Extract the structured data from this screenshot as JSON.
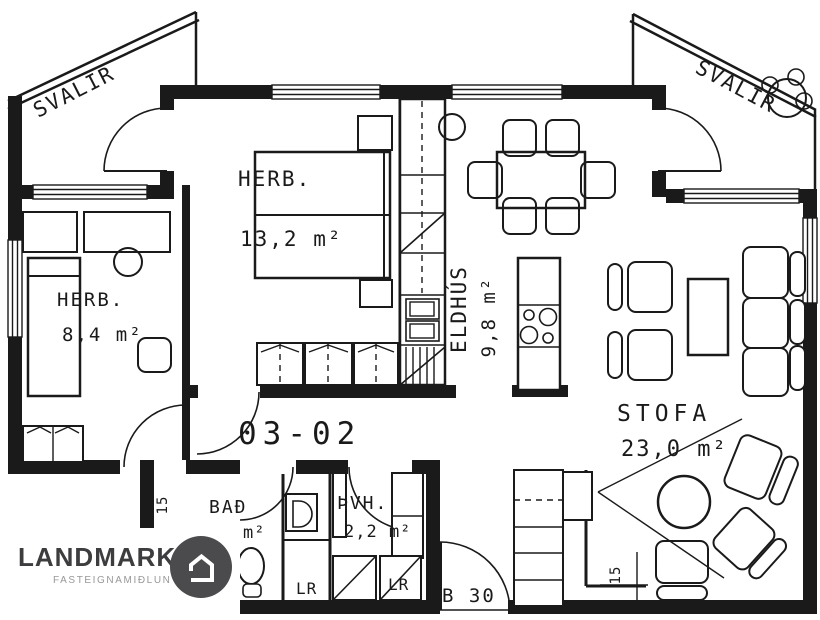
{
  "plan": {
    "unit_number": "03-02",
    "balconies": {
      "left": "SVALIR",
      "right": "SVALIR"
    },
    "rooms": {
      "bedroom_large": {
        "label": "HERB.",
        "area": "13,2 m²"
      },
      "bedroom_small": {
        "label": "HERB.",
        "area": "8,4 m²"
      },
      "kitchen": {
        "label": "ELDHÚS",
        "area": "9,8 m²"
      },
      "living_room": {
        "label": "STOFA",
        "area": "23,0 m²"
      },
      "bathroom": {
        "label": "BAÐ",
        "area_partial": "m²"
      },
      "laundry": {
        "label": "ÞVH.",
        "area": "2,2 m²"
      }
    },
    "closets": {
      "closet_1": "LR",
      "closet_2": "LR"
    },
    "annotations": {
      "entrance_door": "B 30",
      "dim_bathroom_wall": "15",
      "dim_living_room": "15"
    }
  },
  "logo": {
    "title": "LANDMARK",
    "subtitle": "FASTEIGNAMIÐLUN"
  },
  "colors": {
    "ink": "#1a1a1a",
    "logo_title": "#3d3d3f",
    "logo_subtitle": "#98989a",
    "logo_circle": "#4b4b4d"
  }
}
